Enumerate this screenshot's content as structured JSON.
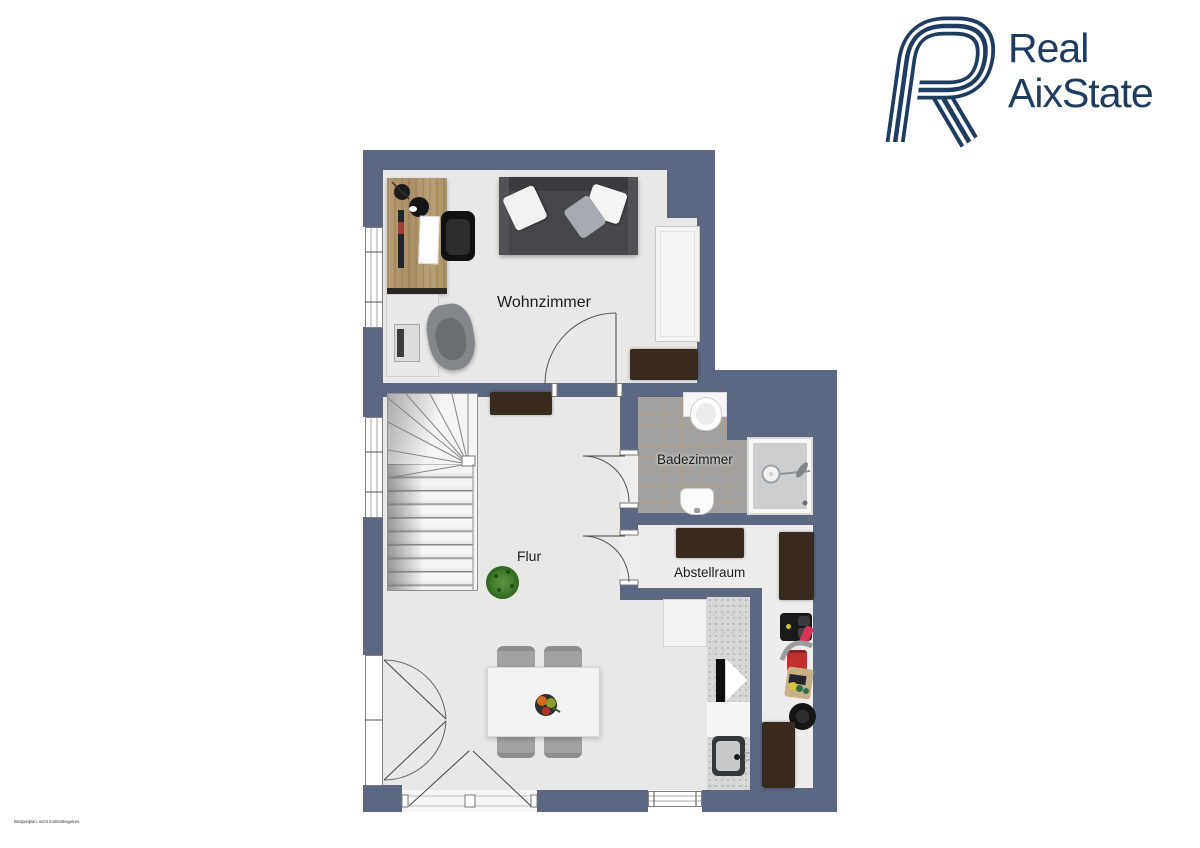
{
  "logo": {
    "line1": "Real",
    "line2": "AixState",
    "mark": "interlaced-R-monogram",
    "color": "#1e3c5f"
  },
  "floorplan": {
    "rooms": {
      "wohnzimmer": "Wohnzimmer",
      "badezimmer": "Badezimmer",
      "flur": "Flur",
      "abstellraum": "Abstellraum"
    },
    "disclaimer": "Beispielplan, nicht maßstabsgetreu",
    "colors": {
      "wall": "#5b6783",
      "floor": "#e9e8e6",
      "bath_tile": "#a1a1a1",
      "logo_navy": "#1e3c5f",
      "dark_furniture": "#392a1e"
    }
  }
}
